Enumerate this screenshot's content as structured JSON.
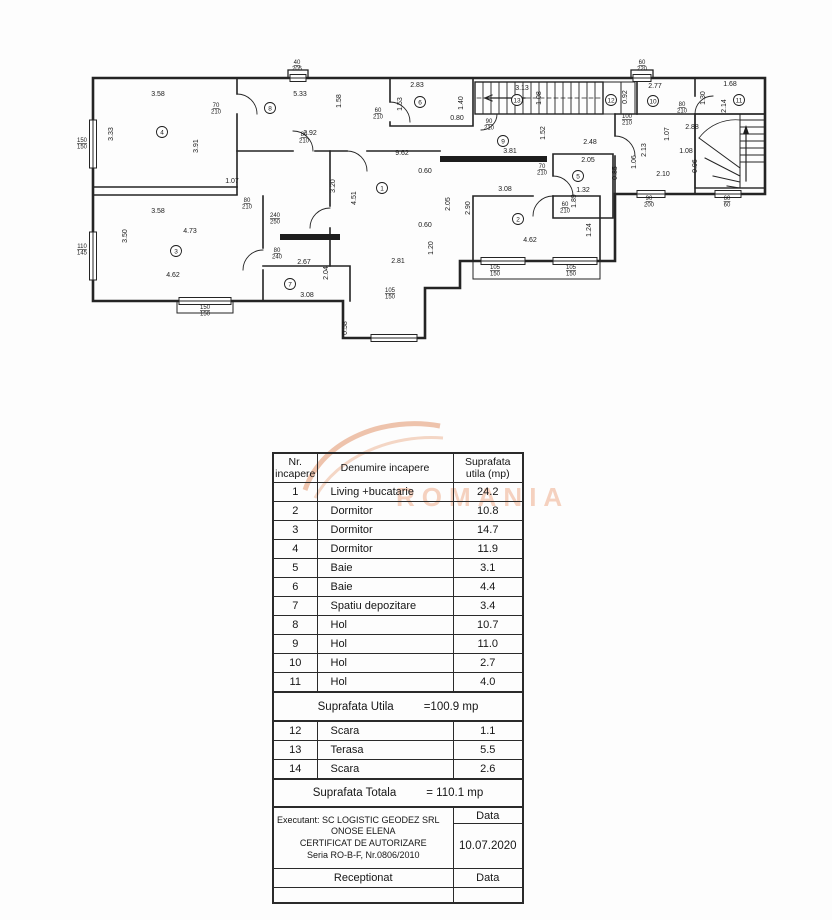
{
  "watermark": {
    "text": "ROMANIA"
  },
  "plan": {
    "room_numbers": [
      {
        "n": "1",
        "x": 297,
        "y": 132
      },
      {
        "n": "2",
        "x": 433,
        "y": 163
      },
      {
        "n": "3",
        "x": 91,
        "y": 195
      },
      {
        "n": "4",
        "x": 77,
        "y": 76
      },
      {
        "n": "5",
        "x": 493,
        "y": 120
      },
      {
        "n": "6",
        "x": 335,
        "y": 46
      },
      {
        "n": "7",
        "x": 205,
        "y": 228
      },
      {
        "n": "8",
        "x": 185,
        "y": 52
      },
      {
        "n": "9",
        "x": 418,
        "y": 85
      },
      {
        "n": "10",
        "x": 568,
        "y": 45
      },
      {
        "n": "11",
        "x": 654,
        "y": 44
      },
      {
        "n": "12",
        "x": 526,
        "y": 44
      },
      {
        "n": "13",
        "x": 432,
        "y": 44
      }
    ],
    "dims": [
      {
        "t": "3.58",
        "x": 73,
        "y": 40
      },
      {
        "t": "5.33",
        "x": 215,
        "y": 40
      },
      {
        "t": "2.83",
        "x": 332,
        "y": 31
      },
      {
        "t": "0.80",
        "x": 372,
        "y": 64
      },
      {
        "t": "3.13",
        "x": 437,
        "y": 34
      },
      {
        "t": "2.77",
        "x": 570,
        "y": 32
      },
      {
        "t": "1.68",
        "x": 645,
        "y": 30
      },
      {
        "t": "9.62",
        "x": 317,
        "y": 99
      },
      {
        "t": "3.81",
        "x": 425,
        "y": 97
      },
      {
        "t": "2.48",
        "x": 505,
        "y": 88
      },
      {
        "t": "2.92",
        "x": 225,
        "y": 79
      },
      {
        "t": "2.88",
        "x": 607,
        "y": 73
      },
      {
        "t": "1.07",
        "x": 147,
        "y": 127
      },
      {
        "t": "3.58",
        "x": 73,
        "y": 157
      },
      {
        "t": "2.05",
        "x": 503,
        "y": 106
      },
      {
        "t": "3.08",
        "x": 420,
        "y": 135
      },
      {
        "t": "1.32",
        "x": 498,
        "y": 136
      },
      {
        "t": "0.60",
        "x": 340,
        "y": 117
      },
      {
        "t": "0.60",
        "x": 340,
        "y": 171
      },
      {
        "t": "4.73",
        "x": 105,
        "y": 177
      },
      {
        "t": "1.08",
        "x": 601,
        "y": 97
      },
      {
        "t": "2.10",
        "x": 578,
        "y": 120
      },
      {
        "t": "2.67",
        "x": 219,
        "y": 208
      },
      {
        "t": "2.81",
        "x": 313,
        "y": 207
      },
      {
        "t": "4.62",
        "x": 88,
        "y": 221
      },
      {
        "t": "4.62",
        "x": 445,
        "y": 186
      },
      {
        "t": "3.08",
        "x": 222,
        "y": 241
      },
      {
        "t": "3.33",
        "x": 28,
        "y": 78,
        "r": 1
      },
      {
        "t": "3.91",
        "x": 113,
        "y": 90,
        "r": 1
      },
      {
        "t": "1.58",
        "x": 256,
        "y": 45,
        "r": 1
      },
      {
        "t": "1.53",
        "x": 317,
        "y": 48,
        "r": 1
      },
      {
        "t": "1.40",
        "x": 378,
        "y": 47,
        "r": 1
      },
      {
        "t": "1.52",
        "x": 460,
        "y": 77,
        "r": 1
      },
      {
        "t": "1.08",
        "x": 456,
        "y": 42,
        "r": 1
      },
      {
        "t": "0.92",
        "x": 542,
        "y": 41,
        "r": 1
      },
      {
        "t": "1.30",
        "x": 620,
        "y": 42,
        "r": 1
      },
      {
        "t": "2.14",
        "x": 641,
        "y": 50,
        "r": 1
      },
      {
        "t": "3.20",
        "x": 250,
        "y": 130,
        "r": 1
      },
      {
        "t": "4.51",
        "x": 271,
        "y": 142,
        "r": 1
      },
      {
        "t": "2.05",
        "x": 365,
        "y": 148,
        "r": 1
      },
      {
        "t": "2.90",
        "x": 385,
        "y": 152,
        "r": 1
      },
      {
        "t": "0.85",
        "x": 532,
        "y": 117,
        "r": 1
      },
      {
        "t": "1.89",
        "x": 491,
        "y": 145,
        "r": 1
      },
      {
        "t": "1.07",
        "x": 584,
        "y": 78,
        "r": 1
      },
      {
        "t": "2.13",
        "x": 561,
        "y": 94,
        "r": 1
      },
      {
        "t": "1.06",
        "x": 551,
        "y": 106,
        "r": 1
      },
      {
        "t": "0.96",
        "x": 612,
        "y": 110,
        "r": 1
      },
      {
        "t": "1.24",
        "x": 506,
        "y": 174,
        "r": 1
      },
      {
        "t": "1.20",
        "x": 348,
        "y": 192,
        "r": 1
      },
      {
        "t": "2.04",
        "x": 243,
        "y": 217,
        "r": 1
      },
      {
        "t": "3.50",
        "x": 42,
        "y": 180,
        "r": 1
      },
      {
        "t": "0.58",
        "x": 262,
        "y": 272,
        "r": 1
      }
    ],
    "size_labels": [
      {
        "t": "40/205",
        "x": 212,
        "y": 8
      },
      {
        "t": "60/220",
        "x": 557,
        "y": 8
      },
      {
        "t": "150/150",
        "x": -3,
        "y": 86
      },
      {
        "t": "110/145",
        "x": -3,
        "y": 192
      },
      {
        "t": "70/210",
        "x": 131,
        "y": 51
      },
      {
        "t": "80/210",
        "x": 219,
        "y": 80
      },
      {
        "t": "60/210",
        "x": 293,
        "y": 56
      },
      {
        "t": "90/210",
        "x": 404,
        "y": 67
      },
      {
        "t": "100/210",
        "x": 542,
        "y": 62
      },
      {
        "t": "80/210",
        "x": 597,
        "y": 50
      },
      {
        "t": "240/250",
        "x": 190,
        "y": 161
      },
      {
        "t": "80/210",
        "x": 162,
        "y": 146
      },
      {
        "t": "80/240",
        "x": 192,
        "y": 196
      },
      {
        "t": "70/210",
        "x": 457,
        "y": 112
      },
      {
        "t": "60/210",
        "x": 480,
        "y": 150
      },
      {
        "t": "105/150",
        "x": 305,
        "y": 236
      },
      {
        "t": "105/150",
        "x": 410,
        "y": 213
      },
      {
        "t": "105/150",
        "x": 486,
        "y": 213
      },
      {
        "t": "150/150",
        "x": 120,
        "y": 253
      },
      {
        "t": "90/200",
        "x": 564,
        "y": 144
      },
      {
        "t": "60/60",
        "x": 642,
        "y": 144
      }
    ]
  },
  "table": {
    "headers": [
      {
        "lines": [
          "Nr.",
          "incapere"
        ]
      },
      {
        "lines": [
          "Denumire incapere"
        ]
      },
      {
        "lines": [
          "Suprafata",
          "utila (mp)"
        ]
      }
    ],
    "rooms": [
      {
        "nr": "1",
        "name": "Living +bucatarie",
        "area": "24.2"
      },
      {
        "nr": "2",
        "name": "Dormitor",
        "area": "10.8"
      },
      {
        "nr": "3",
        "name": "Dormitor",
        "area": "14.7"
      },
      {
        "nr": "4",
        "name": "Dormitor",
        "area": "11.9"
      },
      {
        "nr": "5",
        "name": "Baie",
        "area": "3.1"
      },
      {
        "nr": "6",
        "name": "Baie",
        "area": "4.4"
      },
      {
        "nr": "7",
        "name": "Spatiu depozitare",
        "area": "3.4"
      },
      {
        "nr": "8",
        "name": "Hol",
        "area": "10.7"
      },
      {
        "nr": "9",
        "name": "Hol",
        "area": "11.0"
      },
      {
        "nr": "10",
        "name": "Hol",
        "area": "2.7"
      },
      {
        "nr": "11",
        "name": "Hol",
        "area": "4.0"
      }
    ],
    "subtotal": {
      "label": "Suprafata Utila",
      "value": "=100.9 mp"
    },
    "extra_rooms": [
      {
        "nr": "12",
        "name": "Scara",
        "area": "1.1"
      },
      {
        "nr": "13",
        "name": "Terasa",
        "area": "5.5"
      },
      {
        "nr": "14",
        "name": "Scara",
        "area": "2.6"
      }
    ],
    "total": {
      "label": "Suprafata Totala",
      "value": "= 110.1 mp"
    },
    "footer": {
      "executant_lines": [
        "Executant: SC LOGISTIC GEODEZ SRL",
        "ONOSE ELENA",
        "CERTIFICAT DE AUTORIZARE",
        "Seria RO-B-F, Nr.0806/2010"
      ],
      "data_label": "Data",
      "date": "10.07.2020",
      "receptionat_label": "Receptionat",
      "receptionat_data_label": "Data"
    }
  }
}
